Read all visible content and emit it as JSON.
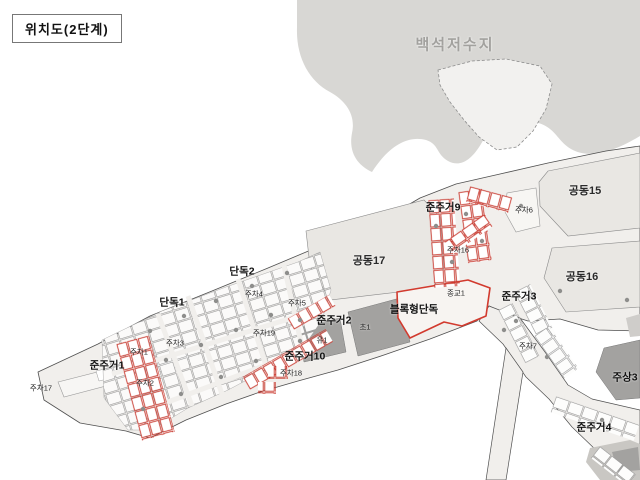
{
  "title": "위치도(2단계)",
  "map": {
    "reservoir": "백석저수지",
    "zones": {
      "gongdong15": "공동15",
      "gongdong16": "공동16",
      "gongdong17": "공동17",
      "junjugeo1": "준주거1",
      "junjugeo2": "준주거2",
      "junjugeo3": "준주거3",
      "junjugeo4": "준주거4",
      "junjugeo9": "준주거9",
      "junjugeo10": "준주거10",
      "dandok1": "단독1",
      "dandok2": "단독2",
      "block_dandok": "블록형단독",
      "jusang3": "주상3",
      "cho1": "초1",
      "yu1": "유1",
      "jonggyo1": "종교1",
      "jucha1": "주차1",
      "jucha2": "주차2",
      "jucha3": "주차3",
      "jucha4": "주차4",
      "jucha5": "주차5",
      "jucha6": "주차6",
      "jucha7": "주차7",
      "jucha16": "주차16",
      "jucha17": "주차17",
      "jucha18": "주차18",
      "jucha19": "주차19"
    },
    "colors": {
      "hills": "#d8d7d4",
      "site": "#f1efec",
      "parcel_large": "#e9e7e3",
      "parcel_dark": "#a3a2a0",
      "lot_outline_red": "#c8372d",
      "lot_outline_gray": "#9a9a9a",
      "reservoir_text": "#a2a19e"
    }
  }
}
